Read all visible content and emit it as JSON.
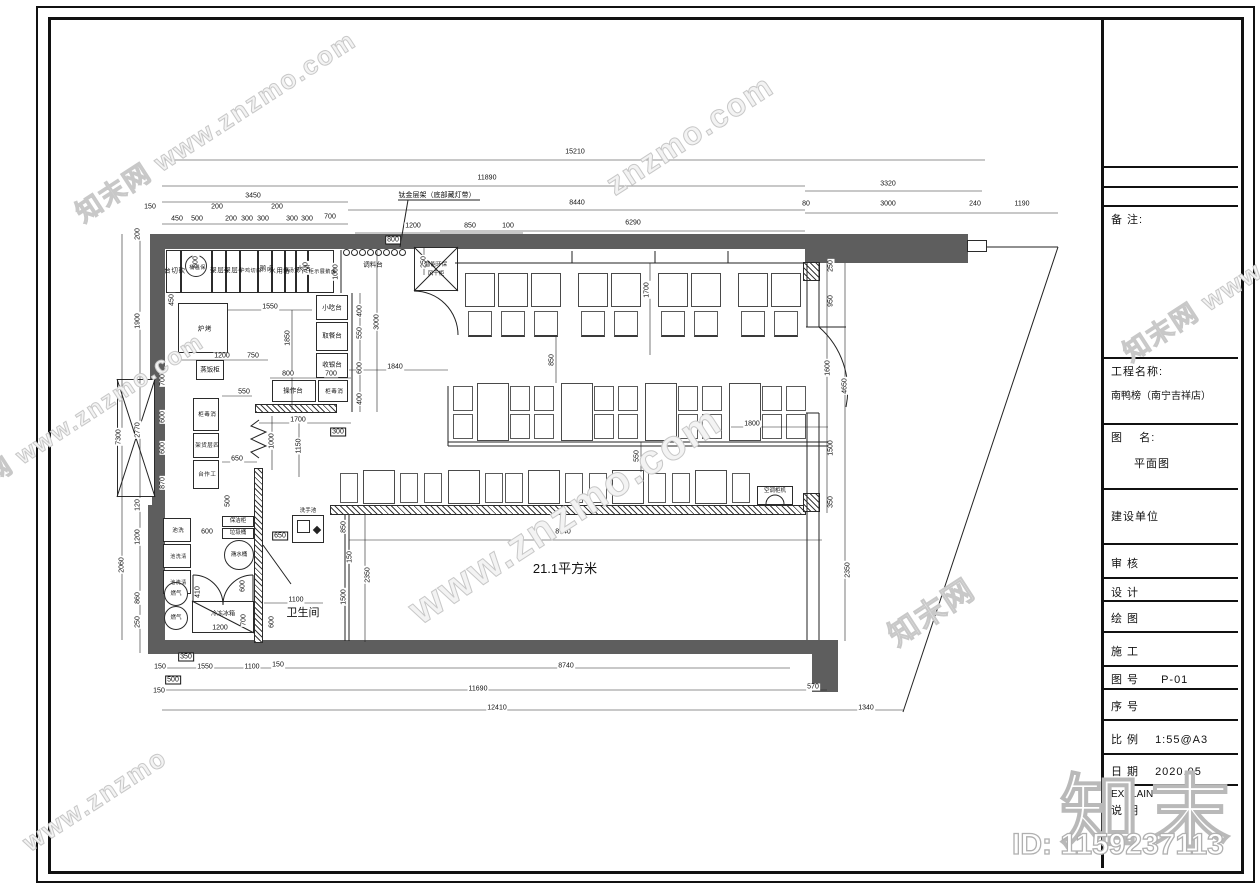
{
  "title_block": {
    "remark_label": "备 注:",
    "project_label": "工程名称:",
    "project_name": "南鸭榜（南宁吉祥店）",
    "drawing_label": "图    名:",
    "drawing_name": "平面图",
    "build_unit_label": "建设单位",
    "review_label": "审 核",
    "design_label": "设 计",
    "draft_label": "绘 图",
    "construction_label": "施 工",
    "fig_no_label": "图 号",
    "fig_no_value": "P-01",
    "seq_label": "序 号",
    "scale_label": "比 例",
    "scale_value": "1:55@A3",
    "date_label": "日 期",
    "date_value": "2020.05",
    "explain_en": "EXPLAIN",
    "explain_cn": "说 明"
  },
  "plan": {
    "area_text": "21.1平方米",
    "shelf_note": "钛金层架（底部藏灯带）",
    "labels": [
      {
        "t": "砍切台",
        "x": 173,
        "y": 270,
        "v": 1
      },
      {
        "t": "保温桶",
        "x": 196,
        "y": 267,
        "v": 1,
        "s": 5
      },
      {
        "t": "4层架",
        "x": 219,
        "y": 270,
        "v": 1
      },
      {
        "t": "4层架",
        "x": 233,
        "y": 270,
        "v": 1
      },
      {
        "t": "白切鸡炉",
        "x": 249,
        "y": 270,
        "v": 1,
        "s": 5
      },
      {
        "t": "卤鹅",
        "x": 265,
        "y": 268,
        "v": 1
      },
      {
        "t": "备用水",
        "x": 278,
        "y": 270,
        "v": 1
      },
      {
        "t": "煲汤炉",
        "x": 290,
        "y": 270,
        "v": 1,
        "s": 5
      },
      {
        "t": "活水",
        "x": 302,
        "y": 268,
        "v": 1
      },
      {
        "t": "卤鹅展示柜",
        "x": 321,
        "y": 271,
        "v": 1,
        "s": 5
      },
      {
        "t": "调料台",
        "x": 373,
        "y": 265
      },
      {
        "t": "智能环保",
        "x": 436,
        "y": 265,
        "s": 5.5
      },
      {
        "t": "风干柜",
        "x": 436,
        "y": 274,
        "s": 5.5
      },
      {
        "t": "烤炉",
        "x": 203,
        "y": 328,
        "v": 1
      },
      {
        "t": "蒸饭柜",
        "x": 210,
        "y": 370
      },
      {
        "t": "消毒柜",
        "x": 206,
        "y": 414,
        "v": 1,
        "s": 5.5
      },
      {
        "t": "四层货架",
        "x": 206,
        "y": 445,
        "v": 1,
        "s": 5.5
      },
      {
        "t": "工作台",
        "x": 206,
        "y": 474,
        "v": 1,
        "s": 5.5
      },
      {
        "t": "小吃台",
        "x": 332,
        "y": 308
      },
      {
        "t": "取餐台",
        "x": 332,
        "y": 336
      },
      {
        "t": "收银台",
        "x": 332,
        "y": 365
      },
      {
        "t": "操作台",
        "x": 293,
        "y": 391
      },
      {
        "t": "消毒柜",
        "x": 333,
        "y": 391,
        "v": 1,
        "s": 5.5
      },
      {
        "t": "保洁柜",
        "x": 238,
        "y": 521,
        "s": 5.5
      },
      {
        "t": "垃圾桶",
        "x": 238,
        "y": 533,
        "s": 5.5
      },
      {
        "t": "潲水桶",
        "x": 239,
        "y": 555,
        "s": 5.5
      },
      {
        "t": "洗池",
        "x": 177,
        "y": 530,
        "v": 1,
        "s": 5.5
      },
      {
        "t": "清洗池",
        "x": 177,
        "y": 556,
        "v": 1,
        "s": 5
      },
      {
        "t": "清洗池",
        "x": 177,
        "y": 582,
        "v": 1,
        "s": 5
      },
      {
        "t": "燃气",
        "x": 176,
        "y": 594,
        "s": 5.5
      },
      {
        "t": "燃气",
        "x": 176,
        "y": 618,
        "s": 5.5
      },
      {
        "t": "冷冻冰箱",
        "x": 223,
        "y": 615,
        "s": 6
      },
      {
        "t": "洗手池",
        "x": 308,
        "y": 511,
        "s": 5.5
      },
      {
        "t": "卫生间",
        "x": 303,
        "y": 613,
        "s": 11
      },
      {
        "t": "空调柜机",
        "x": 775,
        "y": 491,
        "s": 5.5
      },
      {
        "t": "21.1平方米",
        "x": 565,
        "y": 569,
        "s": 13
      }
    ],
    "dims": [
      {
        "t": "15210",
        "x": 575,
        "y": 152
      },
      {
        "t": "11890",
        "x": 487,
        "y": 178
      },
      {
        "t": "3450",
        "x": 253,
        "y": 196
      },
      {
        "t": "8440",
        "x": 577,
        "y": 203
      },
      {
        "t": "3320",
        "x": 888,
        "y": 184
      },
      {
        "t": "80",
        "x": 806,
        "y": 204
      },
      {
        "t": "3000",
        "x": 888,
        "y": 204
      },
      {
        "t": "240",
        "x": 975,
        "y": 204
      },
      {
        "t": "1190",
        "x": 1022,
        "y": 204
      },
      {
        "t": "6290",
        "x": 633,
        "y": 223
      },
      {
        "t": "150",
        "x": 150,
        "y": 207
      },
      {
        "t": "450",
        "x": 177,
        "y": 219
      },
      {
        "t": "500",
        "x": 197,
        "y": 219
      },
      {
        "t": "200",
        "x": 217,
        "y": 207
      },
      {
        "t": "200",
        "x": 231,
        "y": 219
      },
      {
        "t": "300",
        "x": 247,
        "y": 219
      },
      {
        "t": "300",
        "x": 263,
        "y": 219
      },
      {
        "t": "200",
        "x": 277,
        "y": 207
      },
      {
        "t": "300",
        "x": 292,
        "y": 219
      },
      {
        "t": "300",
        "x": 307,
        "y": 219
      },
      {
        "t": "700",
        "x": 330,
        "y": 217
      },
      {
        "t": "1200",
        "x": 413,
        "y": 226
      },
      {
        "t": "800",
        "x": 393,
        "y": 240,
        "box": 1
      },
      {
        "t": "850",
        "x": 470,
        "y": 226
      },
      {
        "t": "100",
        "x": 508,
        "y": 226
      },
      {
        "t": "250",
        "x": 424,
        "y": 262,
        "r": 1
      },
      {
        "t": "200",
        "x": 138,
        "y": 234,
        "r": 1
      },
      {
        "t": "1900",
        "x": 138,
        "y": 321,
        "r": 1
      },
      {
        "t": "2770",
        "x": 138,
        "y": 430,
        "r": 1
      },
      {
        "t": "7300",
        "x": 119,
        "y": 437,
        "r": 1
      },
      {
        "t": "700",
        "x": 163,
        "y": 380,
        "r": 1
      },
      {
        "t": "600",
        "x": 163,
        "y": 417,
        "r": 1
      },
      {
        "t": "600",
        "x": 163,
        "y": 448,
        "r": 1
      },
      {
        "t": "870",
        "x": 163,
        "y": 483,
        "r": 1
      },
      {
        "t": "120",
        "x": 138,
        "y": 505,
        "r": 1
      },
      {
        "t": "1200",
        "x": 138,
        "y": 537,
        "r": 1
      },
      {
        "t": "2060",
        "x": 122,
        "y": 565,
        "r": 1
      },
      {
        "t": "860",
        "x": 138,
        "y": 598,
        "r": 1
      },
      {
        "t": "250",
        "x": 138,
        "y": 622,
        "r": 1
      },
      {
        "t": "600",
        "x": 196,
        "y": 262,
        "r": 1
      },
      {
        "t": "450",
        "x": 172,
        "y": 300,
        "r": 1
      },
      {
        "t": "700",
        "x": 306,
        "y": 268,
        "r": 1
      },
      {
        "t": "1000",
        "x": 336,
        "y": 272,
        "r": 1
      },
      {
        "t": "1550",
        "x": 270,
        "y": 307
      },
      {
        "t": "1850",
        "x": 288,
        "y": 338,
        "r": 1
      },
      {
        "t": "1200",
        "x": 222,
        "y": 356
      },
      {
        "t": "750",
        "x": 253,
        "y": 356
      },
      {
        "t": "800",
        "x": 288,
        "y": 374
      },
      {
        "t": "700",
        "x": 331,
        "y": 374
      },
      {
        "t": "550",
        "x": 244,
        "y": 392
      },
      {
        "t": "650",
        "x": 237,
        "y": 459
      },
      {
        "t": "500",
        "x": 228,
        "y": 501,
        "r": 1
      },
      {
        "t": "600",
        "x": 207,
        "y": 532
      },
      {
        "t": "650",
        "x": 280,
        "y": 536,
        "box": 1
      },
      {
        "t": "1700",
        "x": 298,
        "y": 420
      },
      {
        "t": "1000",
        "x": 272,
        "y": 441,
        "r": 1
      },
      {
        "t": "1150",
        "x": 299,
        "y": 446,
        "r": 1
      },
      {
        "t": "300",
        "x": 338,
        "y": 432,
        "box": 1
      },
      {
        "t": "410",
        "x": 198,
        "y": 592,
        "r": 1
      },
      {
        "t": "600",
        "x": 243,
        "y": 586,
        "r": 1
      },
      {
        "t": "700",
        "x": 244,
        "y": 620,
        "r": 1
      },
      {
        "t": "1200",
        "x": 220,
        "y": 628
      },
      {
        "t": "1100",
        "x": 296,
        "y": 600
      },
      {
        "t": "600",
        "x": 272,
        "y": 622,
        "r": 1
      },
      {
        "t": "3000",
        "x": 377,
        "y": 322,
        "r": 1
      },
      {
        "t": "400",
        "x": 360,
        "y": 311,
        "r": 1
      },
      {
        "t": "550",
        "x": 360,
        "y": 333,
        "r": 1
      },
      {
        "t": "600",
        "x": 360,
        "y": 368,
        "r": 1
      },
      {
        "t": "400",
        "x": 360,
        "y": 399,
        "r": 1
      },
      {
        "t": "1840",
        "x": 395,
        "y": 367
      },
      {
        "t": "1700",
        "x": 647,
        "y": 290,
        "r": 1
      },
      {
        "t": "850",
        "x": 552,
        "y": 360,
        "r": 1
      },
      {
        "t": "550",
        "x": 637,
        "y": 456,
        "r": 1
      },
      {
        "t": "1800",
        "x": 752,
        "y": 424
      },
      {
        "t": "250",
        "x": 831,
        "y": 266,
        "r": 1
      },
      {
        "t": "950",
        "x": 831,
        "y": 301,
        "r": 1
      },
      {
        "t": "1600",
        "x": 828,
        "y": 368,
        "r": 1
      },
      {
        "t": "4650",
        "x": 845,
        "y": 386,
        "r": 1
      },
      {
        "t": "1500",
        "x": 831,
        "y": 448,
        "r": 1
      },
      {
        "t": "350",
        "x": 831,
        "y": 502,
        "r": 1
      },
      {
        "t": "2350",
        "x": 848,
        "y": 570,
        "r": 1
      },
      {
        "t": "850",
        "x": 344,
        "y": 527,
        "r": 1
      },
      {
        "t": "150",
        "x": 350,
        "y": 557,
        "r": 1
      },
      {
        "t": "2350",
        "x": 368,
        "y": 575,
        "r": 1
      },
      {
        "t": "1500",
        "x": 344,
        "y": 597,
        "r": 1
      },
      {
        "t": "8740",
        "x": 563,
        "y": 532
      },
      {
        "t": "350",
        "x": 186,
        "y": 657,
        "box": 1
      },
      {
        "t": "150",
        "x": 160,
        "y": 667
      },
      {
        "t": "1550",
        "x": 205,
        "y": 667
      },
      {
        "t": "1100",
        "x": 252,
        "y": 667
      },
      {
        "t": "150",
        "x": 278,
        "y": 665
      },
      {
        "t": "8740",
        "x": 566,
        "y": 666
      },
      {
        "t": "500",
        "x": 173,
        "y": 680,
        "box": 1
      },
      {
        "t": "150",
        "x": 159,
        "y": 691
      },
      {
        "t": "11690",
        "x": 478,
        "y": 689
      },
      {
        "t": "570",
        "x": 813,
        "y": 687
      },
      {
        "t": "12410",
        "x": 497,
        "y": 708
      },
      {
        "t": "1340",
        "x": 866,
        "y": 708
      }
    ]
  },
  "watermarks": [
    {
      "t": "www.znzmo.com",
      "x": 565,
      "y": 515,
      "r": -33,
      "s": 42
    },
    {
      "t": "知末网 www.znzmo.com",
      "x": 215,
      "y": 125,
      "r": -33,
      "s": 26
    },
    {
      "t": "znzmo.com",
      "x": 690,
      "y": 135,
      "r": -33,
      "s": 32
    },
    {
      "t": "知末网 www.znzmo.com",
      "x": 72,
      "y": 420,
      "r": -33,
      "s": 24
    },
    {
      "t": "知末网 www",
      "x": 1192,
      "y": 310,
      "r": -33,
      "s": 26
    },
    {
      "t": "知末网",
      "x": 930,
      "y": 610,
      "r": -33,
      "s": 30
    },
    {
      "t": "www.znzmo",
      "x": 95,
      "y": 800,
      "r": -33,
      "s": 26
    }
  ],
  "watermark_logo": "知末",
  "watermark_id": "ID: 1159237113"
}
